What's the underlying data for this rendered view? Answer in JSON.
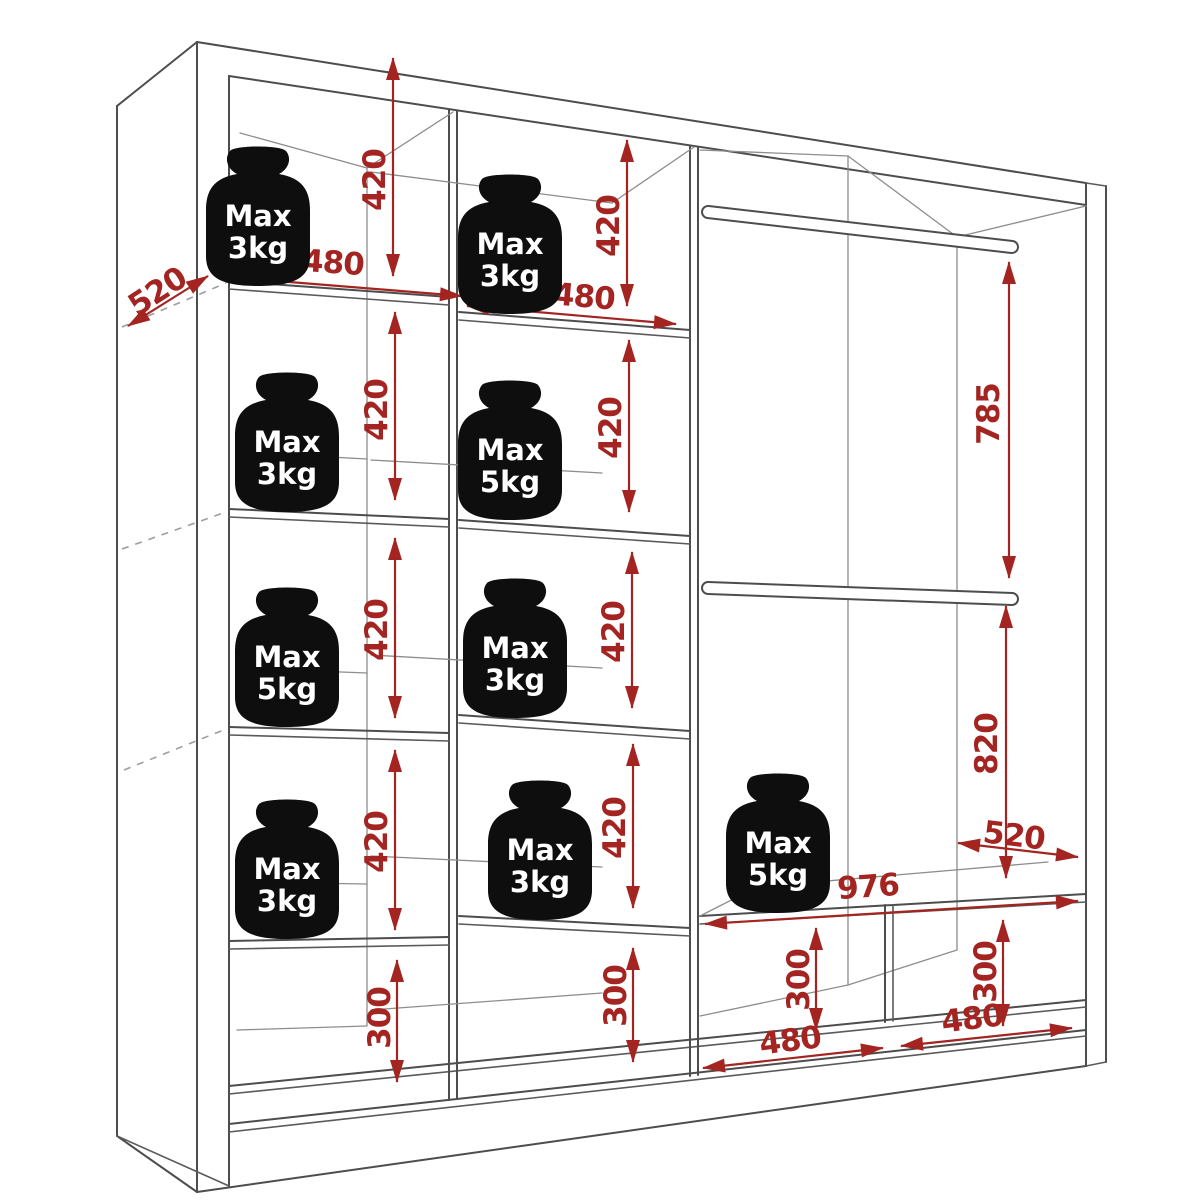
{
  "diagram": {
    "type": "wardrobe-interior-dimension-drawing",
    "colors": {
      "background": "#ffffff",
      "outline": "#4d4d4d",
      "dimension": "#a32420",
      "weight_fill": "#0e0e0e",
      "weight_text": "#ffffff"
    },
    "left_column": {
      "width": "480",
      "depth": "520",
      "row1": {
        "height": "420",
        "weight_line1": "Max",
        "weight_line2": "3kg"
      },
      "row2": {
        "height": "420",
        "weight_line1": "Max",
        "weight_line2": "3kg"
      },
      "row3": {
        "height": "420",
        "weight_line1": "Max",
        "weight_line2": "5kg"
      },
      "row4": {
        "height": "420",
        "weight_line1": "Max",
        "weight_line2": "3kg"
      },
      "bottom": {
        "height": "300"
      }
    },
    "middle_column": {
      "width": "480",
      "row1": {
        "height": "420",
        "weight_line1": "Max",
        "weight_line2": "3kg"
      },
      "row2": {
        "height": "420",
        "weight_line1": "Max",
        "weight_line2": "5kg"
      },
      "row3": {
        "height": "420",
        "weight_line1": "Max",
        "weight_line2": "3kg"
      },
      "row4": {
        "height": "420",
        "weight_line1": "Max",
        "weight_line2": "3kg"
      },
      "bottom": {
        "height": "300"
      }
    },
    "right_section": {
      "upper_rod_to_lower_rod": "785",
      "lower_rod_to_bench": "820",
      "bench": {
        "width": "976",
        "depth": "520",
        "weight_line1": "Max",
        "weight_line2": "5kg"
      },
      "bottom_left": {
        "height": "300",
        "width": "480"
      },
      "bottom_right": {
        "height": "300",
        "width": "480"
      }
    }
  }
}
